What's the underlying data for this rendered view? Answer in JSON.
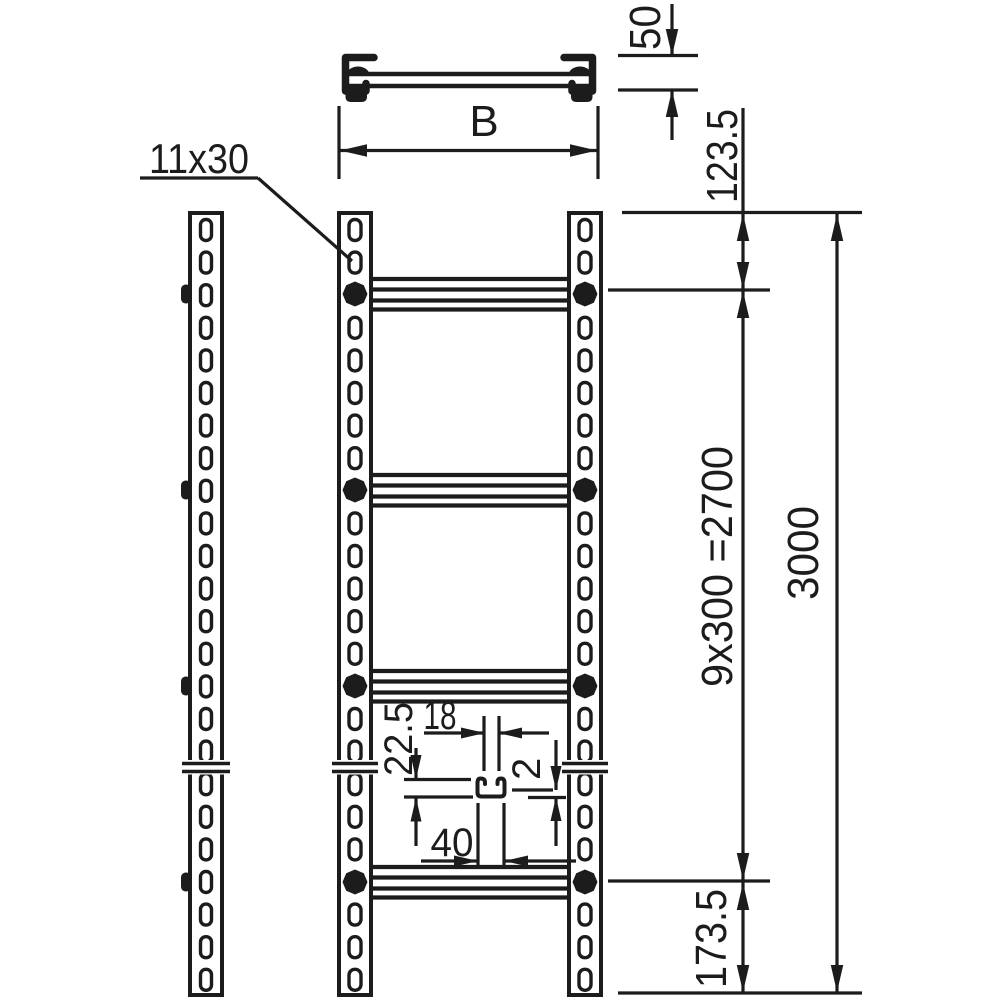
{
  "drawing": {
    "description": "Technical dimension drawing of a rung cable ladder: side view of rail, front view of ladder with rungs, top cross-section view, rung C-profile detail",
    "background_color": "#ffffff",
    "line_color": "#1c1c1c",
    "labels": {
      "slot_size": "11x30",
      "width": "B",
      "profile_height": "50",
      "first_rung_offset": "123.5",
      "rung_spacing": "9x300 =2700",
      "total_length": "3000",
      "last_rung_offset": "173.5",
      "rung_profile_width": "40",
      "rung_profile_height": "22.5",
      "rung_profile_opening": "18",
      "rung_profile_thickness": "2"
    }
  }
}
